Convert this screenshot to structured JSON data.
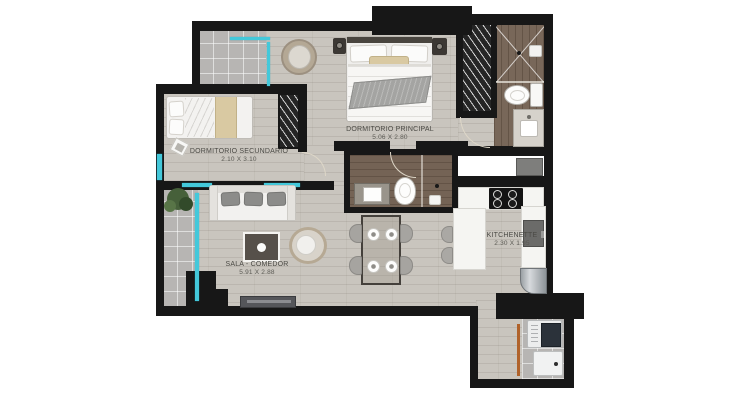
{
  "rooms": {
    "principal": {
      "name": "DORMITORIO PRINCIPAL",
      "dims": "5.06 X 2.80"
    },
    "secundario": {
      "name": "DORMITORIO SECUNDARIO",
      "dims": "2.10 X 3.10"
    },
    "sala": {
      "name": "SALA - COMEDOR",
      "dims": "5.91 X 2.88"
    },
    "kitchenette": {
      "name": "KITCHENETTE",
      "dims": "2.30 X 1.95"
    }
  },
  "colors": {
    "wall": "#171717",
    "floor_wood_light": "#c9c5be",
    "floor_wood_dark": "#786759",
    "floor_tile": "#b7b5b3",
    "window_glass": "#43c8da",
    "counter": "#f5f5f2",
    "laundry_door": "#b0622a",
    "label_text": "#4b4a45"
  }
}
